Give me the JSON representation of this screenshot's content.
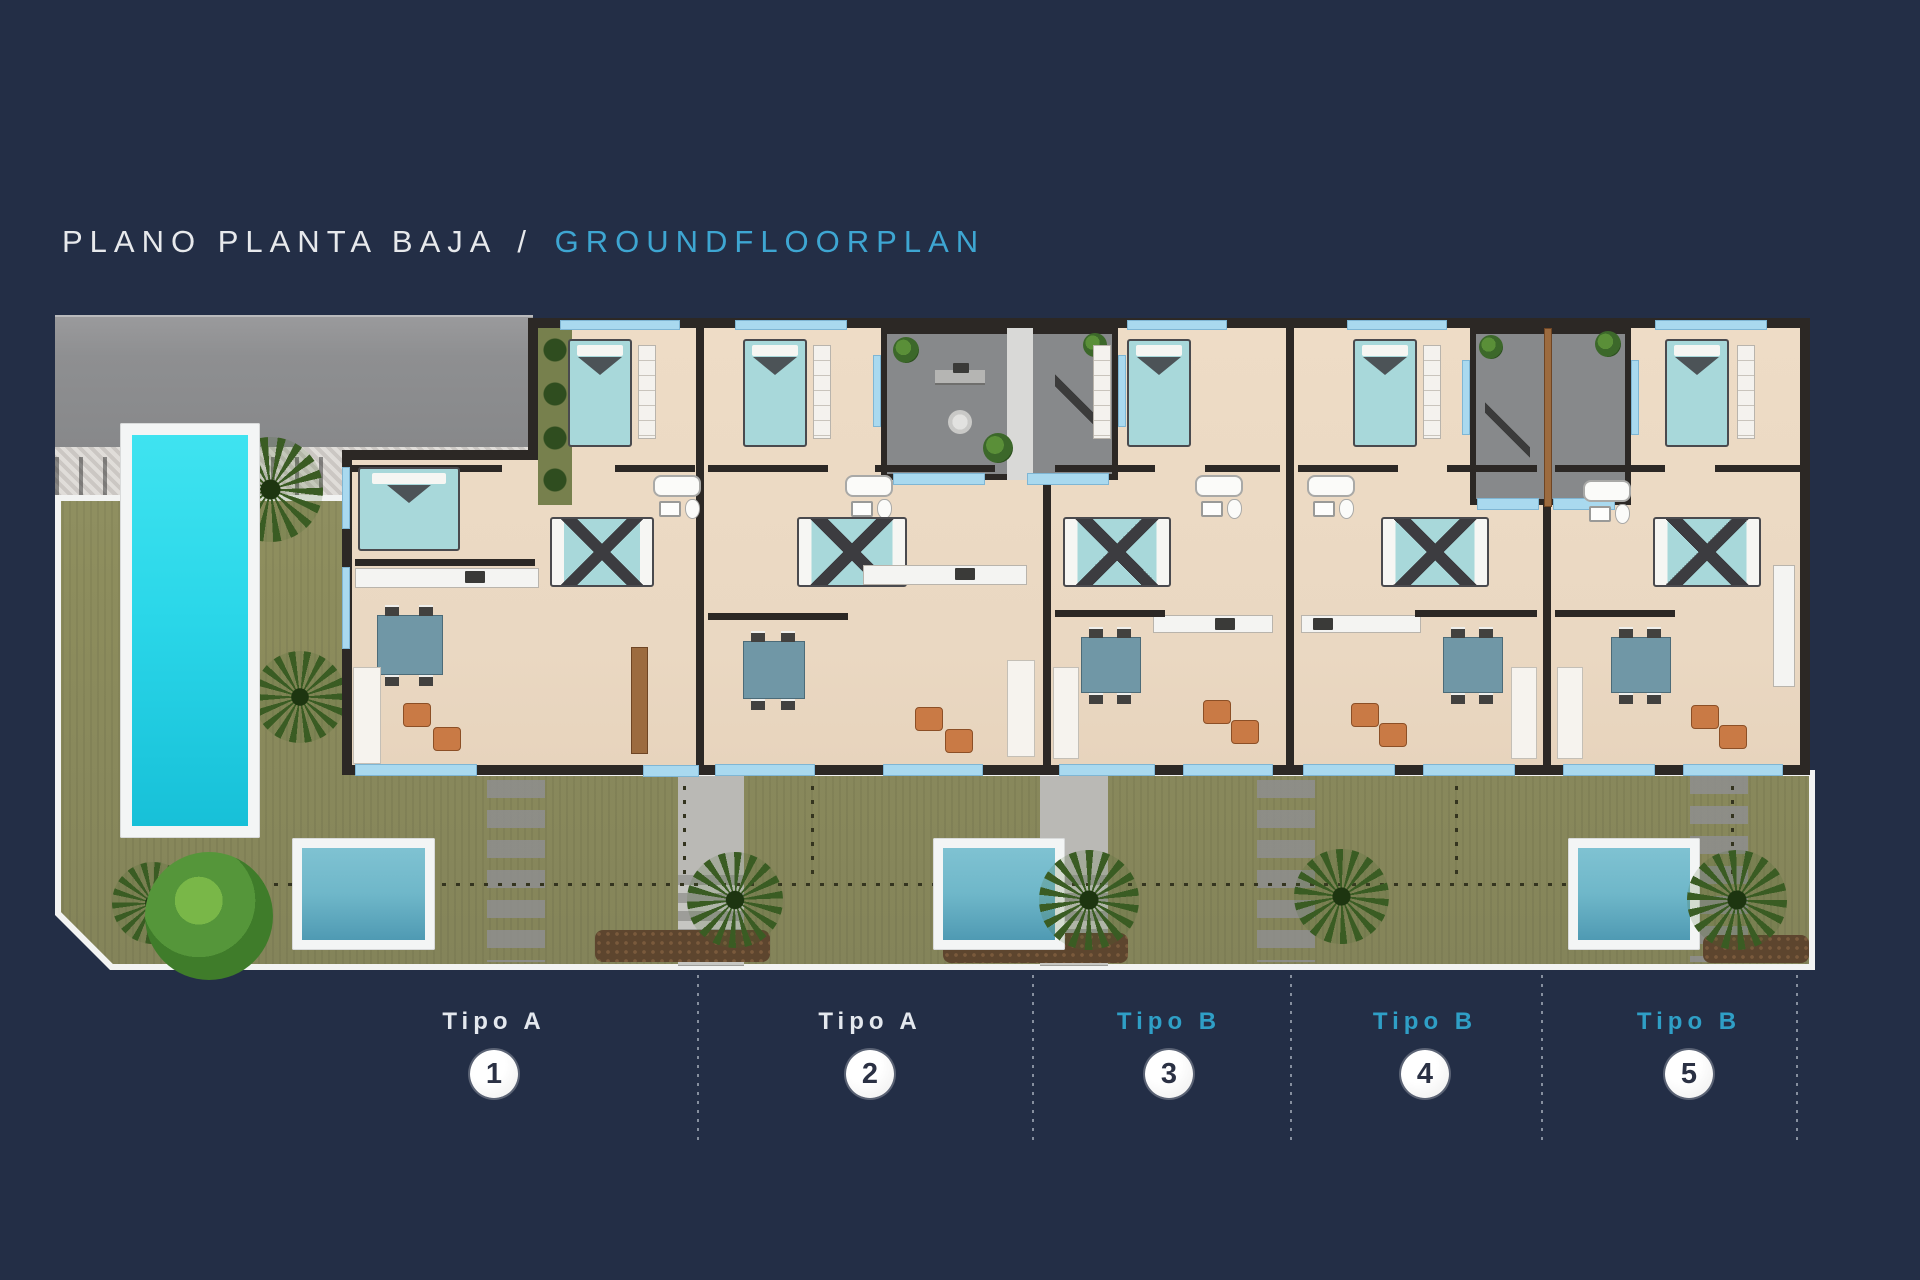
{
  "title": {
    "left": "PLANO PLANTA BAJA",
    "separator": "/",
    "right": "GROUNDFLOORPLAN"
  },
  "units": [
    {
      "type_label": "Tipo A",
      "number": "1",
      "type": "A"
    },
    {
      "type_label": "Tipo A",
      "number": "2",
      "type": "A"
    },
    {
      "type_label": "Tipo B",
      "number": "3",
      "type": "B"
    },
    {
      "type_label": "Tipo B",
      "number": "4",
      "type": "B"
    },
    {
      "type_label": "Tipo B",
      "number": "5",
      "type": "B"
    }
  ],
  "palette": {
    "background_navy": "#232e46",
    "title_white": "#e7e9ec",
    "accent_blue": "#3ea6d2",
    "label_blue": "#2f9fc6",
    "circle_bg": "#f3f3f3",
    "circle_number": "#2b3144",
    "pool_cyan": "#2bd7e9",
    "plunge_pool_blue": "#6fb7c9",
    "grass_green": "#8d8d5d",
    "building_wall": "#2c2825",
    "floor_beige": "#ead8c2",
    "window_blue": "#a9d9ef",
    "patio_gray": "#87898b",
    "driveway_gray": "#8e8f91",
    "armchair_orange": "#c97a45",
    "table_slate": "#7097a6"
  }
}
